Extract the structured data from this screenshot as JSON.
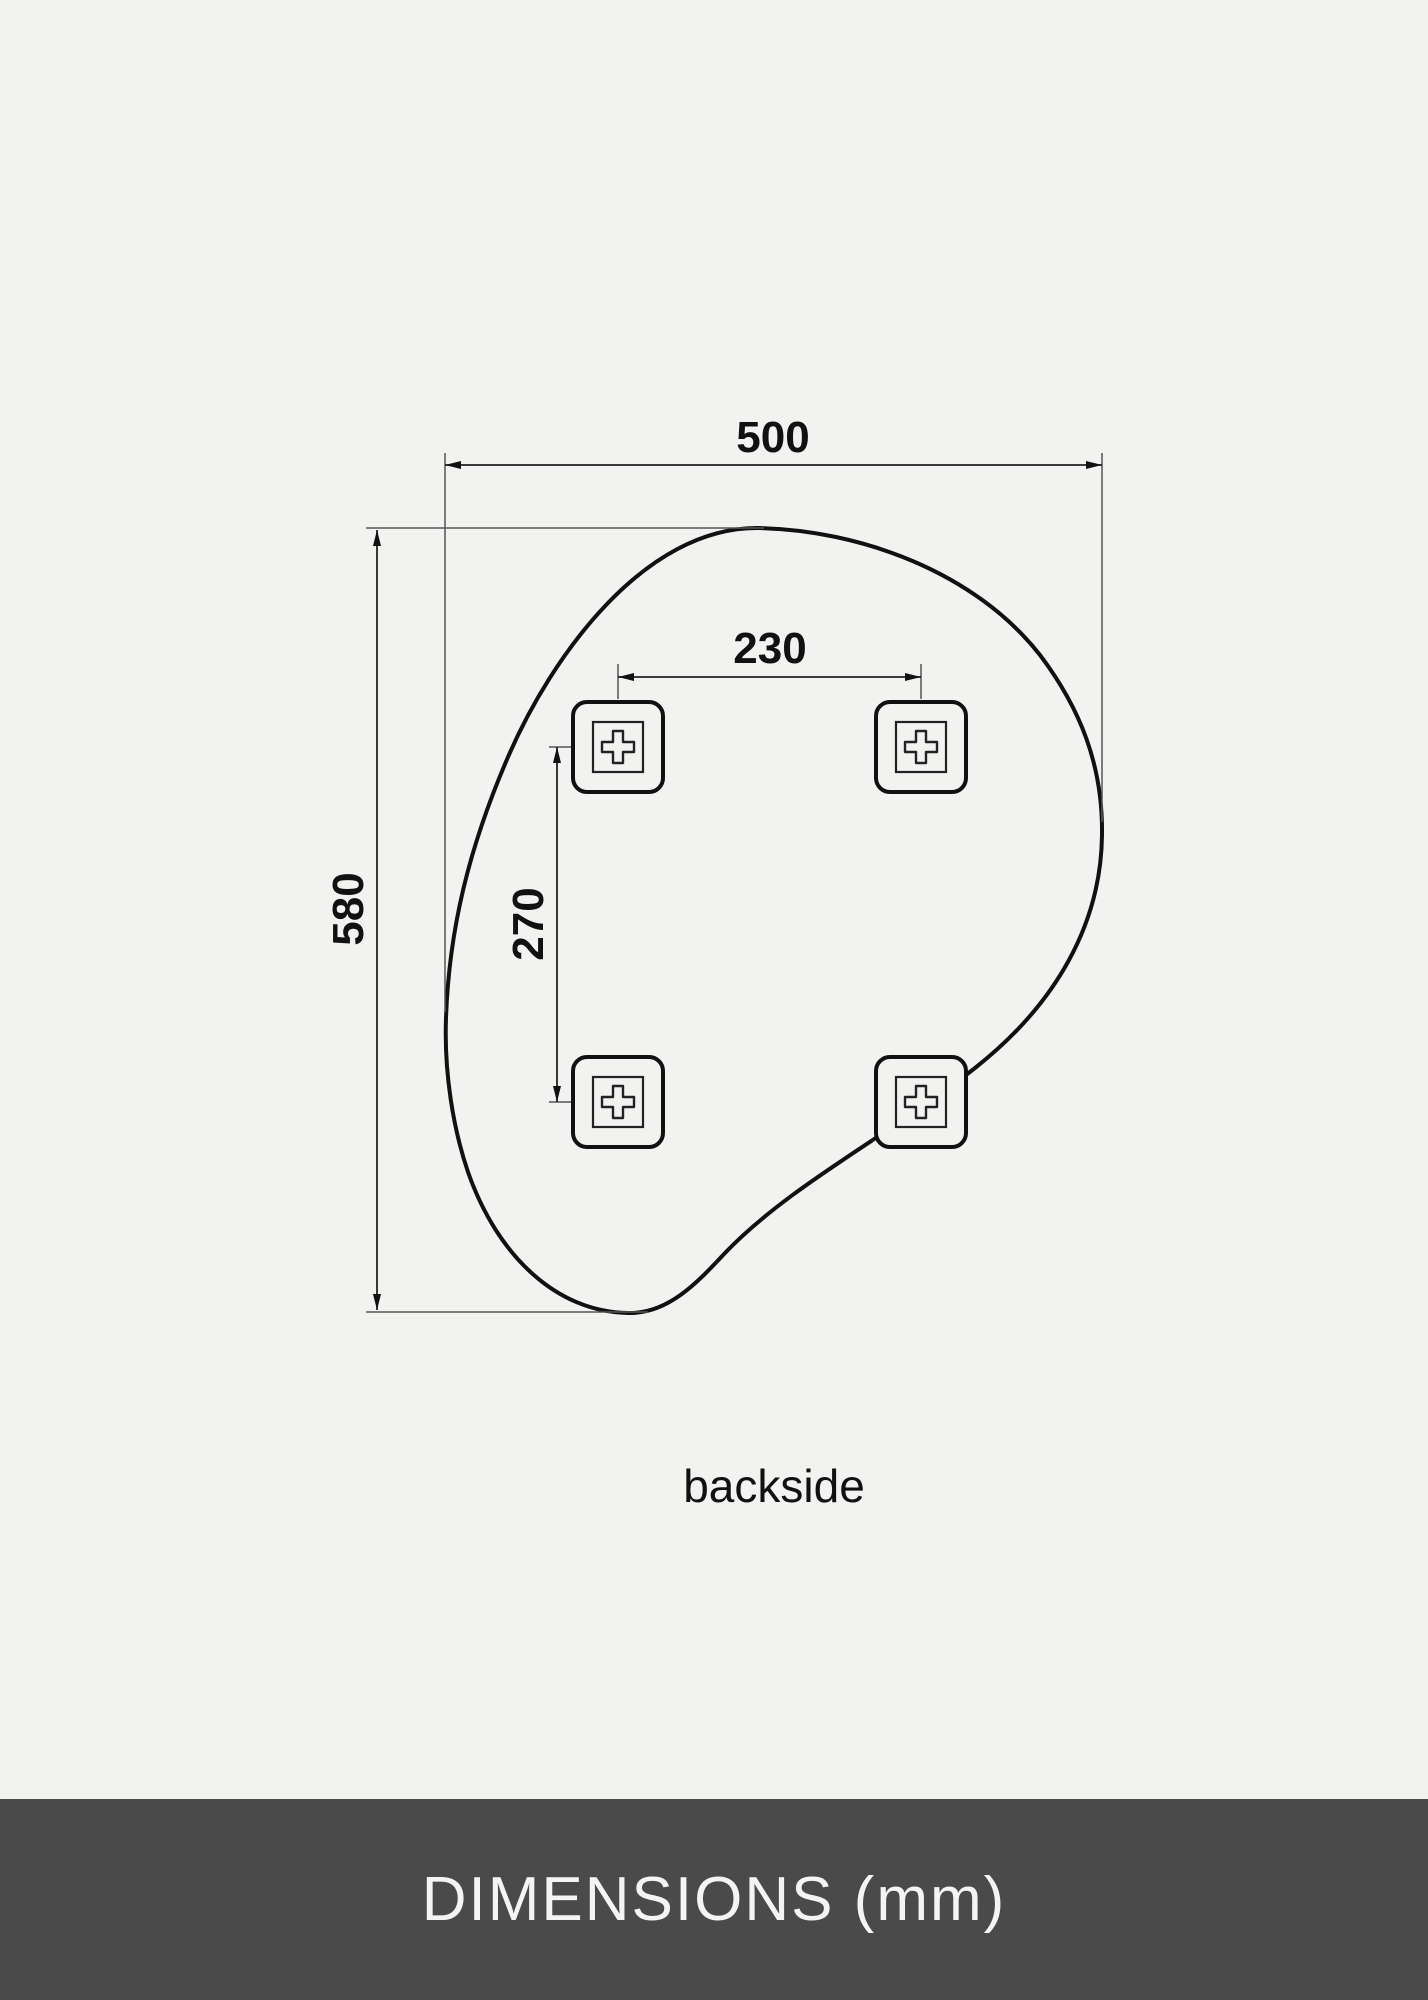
{
  "diagram": {
    "overall_width_mm": "500",
    "overall_height_mm": "580",
    "bracket_spacing_horizontal_mm": "230",
    "bracket_spacing_vertical_mm": "270",
    "caption": "backside",
    "background_color": "#f2f2f0",
    "outline_color": "#111111",
    "dimension_line_color": "#222222",
    "bracket_icon": "plus-screw-mount"
  },
  "footer": {
    "title": "DIMENSIONS (mm)",
    "background_color": "#4a4a4a",
    "text_color": "#f4f4f4"
  }
}
